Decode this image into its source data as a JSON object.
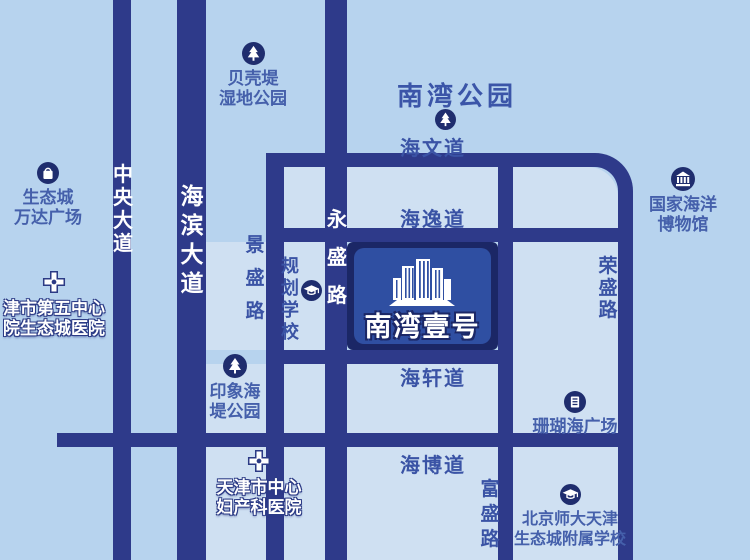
{
  "project_badge": {
    "name": "南湾壹号"
  },
  "roads": {
    "zhongyang_avenue": "中央大道",
    "haibin_avenue": "海滨大道",
    "jingsheng_road": "景盛路",
    "yongsheng_road": "永盛路",
    "fusheng_road": "富盛路",
    "rongsheng_road": "荣盛路",
    "haiwen_street": "海文道",
    "haiyi_street": "海逸道",
    "haixuan_street": "海轩道",
    "haibo_street": "海博道"
  },
  "pois": {
    "nanwan_park": {
      "name": "南湾公园"
    },
    "beiketi_wetland_park": {
      "line1": "贝壳堤",
      "line2": "湿地公园"
    },
    "wanda_plaza": {
      "line1": "生态城",
      "line2": "万达广场"
    },
    "fifth_center_hospital": {
      "line1": "津市第五中心",
      "line2": "院生态城医院"
    },
    "planned_school": {
      "name": "规划学校"
    },
    "national_maritime_museum": {
      "line1": "国家海洋",
      "line2": "博物馆"
    },
    "yinxiang_seawall_park": {
      "line1": "印象海",
      "line2": "堤公园"
    },
    "shanhuhai_plaza": {
      "name": "珊瑚海广场"
    },
    "central_maternity_hospital": {
      "line1": "天津市中心",
      "line2": "妇产科医院"
    },
    "bnu_tianjin_school": {
      "line1": "北京师大天津",
      "line2": "生态城附属学校"
    }
  },
  "colors": {
    "background": "#b7d3ee",
    "city_block": "#cfe0f2",
    "road": "#2e3a8a",
    "badge_outer": "#1b2766",
    "badge_inner": "#2f4fa2",
    "label_blue": "#3a53a5",
    "label_white": "#ffffff"
  }
}
